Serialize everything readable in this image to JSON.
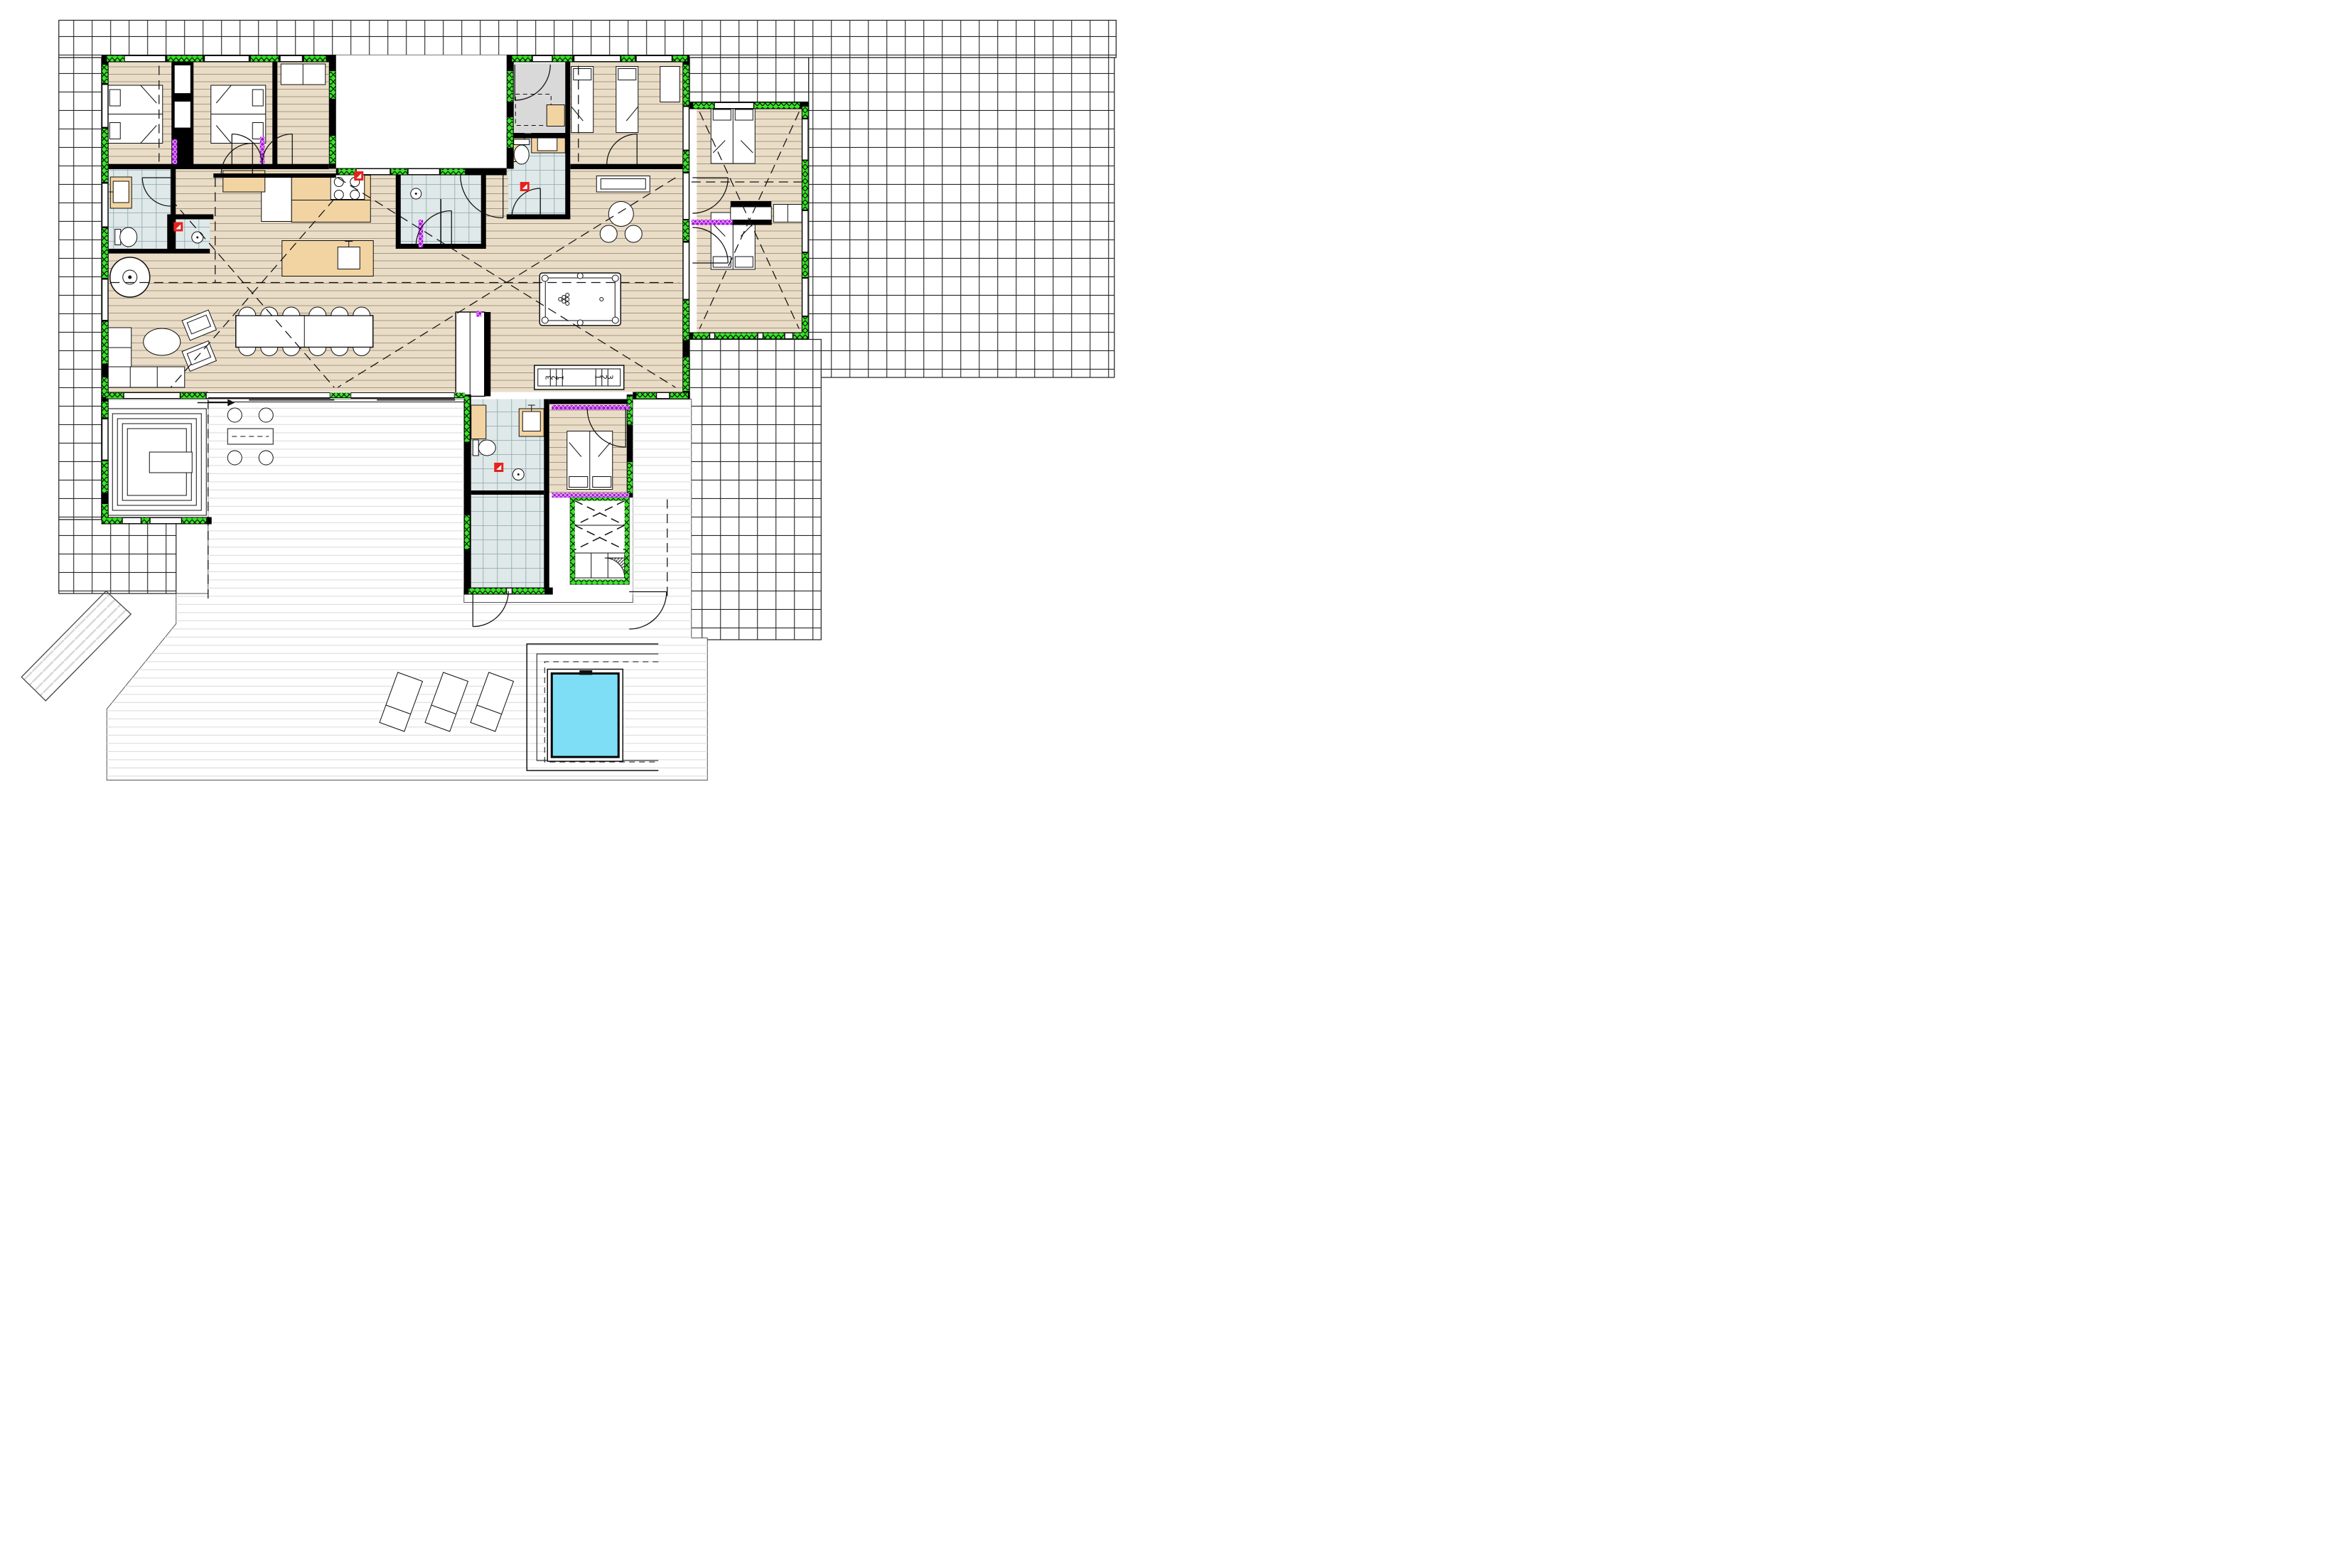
{
  "plan": {
    "type": "architectural-floor-plan",
    "shuffleboard_numbers_left": [
      "3",
      "2",
      "1"
    ],
    "shuffleboard_numbers_right": [
      "1",
      "2",
      "3"
    ]
  },
  "colors": {
    "paper": "#ffffff",
    "ink": "#111111",
    "wall": "#000000",
    "insulation": "#3ce32b",
    "vapor": "#a911dd",
    "alarm": "#e8211b",
    "wood": "#eaddc8",
    "woodline": "#a5967e",
    "bath": "#dfe9ea",
    "bathline": "#8ea4a7",
    "grayroom": "#d9d9d9",
    "tan": "#f2d4a3",
    "deckline": "#e0e0e0",
    "tileline": "#262626",
    "pool": "#7edef5"
  },
  "icons": {
    "smoke_detector": "red-square-white-triangle",
    "door_swing": "quarter-arc",
    "insulation_marker": "green-crosshatch",
    "vapor_barrier_marker": "purple-crosshatch"
  }
}
